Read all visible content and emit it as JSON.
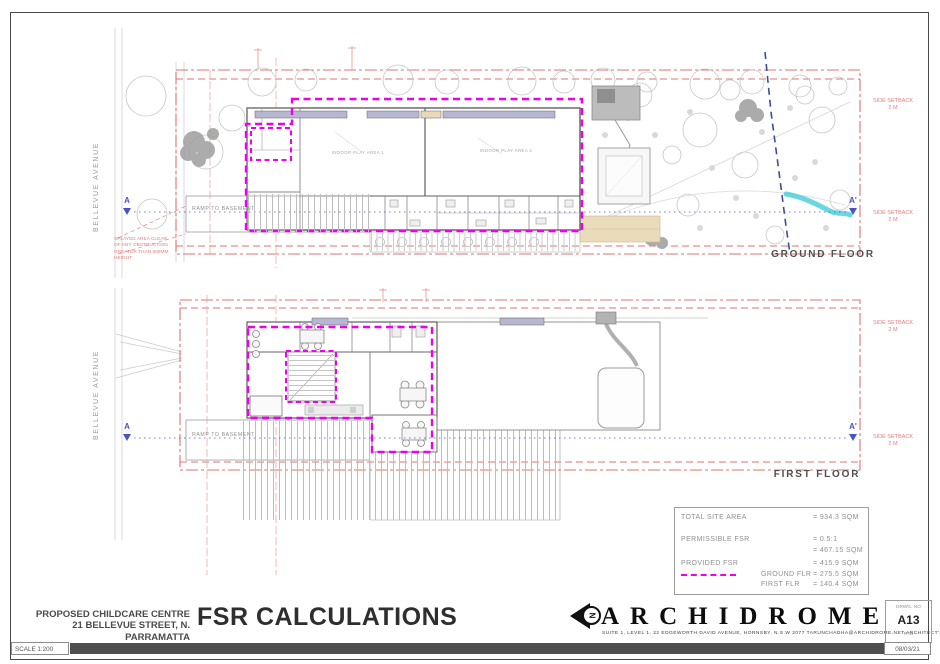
{
  "page": {
    "scale_label": "SCALE 1:200",
    "date": "08/03/21"
  },
  "title_block": {
    "project_line1": "PROPOSED CHILDCARE CENTRE",
    "project_line2": "21 BELLEVUE STREET, N. PARRAMATTA",
    "sheet_title": "FSR CALCULATIONS",
    "firm_name": "ARCHIDROME",
    "north_letter": "N",
    "firm_details": "SUITE 1, LEVEL 1, 22 EDGEWORTH DAVID AVENUE, HORNSBY, N.S.W 2077     TARUNCHADHA@ARCHIDROME.NET     ARCHITECT'S REG. NO. 8777",
    "drwg_no_label": "DRWG. NO",
    "drwg_no": "A13",
    "revision": "R-00"
  },
  "fsr_table": {
    "total_label": "TOTAL SITE AREA",
    "total_value": "= 934.3 SQM",
    "permissible_label": "PERMISSIBLE FSR",
    "permissible_ratio": "= 0.5:1",
    "permissible_value": "= 467.15 SQM",
    "provided_label": "PROVIDED FSR",
    "provided_value": "= 415.9 SQM",
    "ground_label": "GROUND FLR",
    "ground_value": "= 275.5 SQM",
    "first_label": "FIRST FLR",
    "first_value": "= 140.4 SQM"
  },
  "plans": {
    "street_name": "BELLEVUE AVENUE",
    "ramp_label": "RAMP TO BASEMENT",
    "setback_line1": "SIDE SETBACK",
    "setback_line2": "2 M",
    "section_a": "A",
    "section_a_prime": "A'",
    "ground_floor_label": "GROUND FLOOR",
    "first_floor_label": "FIRST FLOOR",
    "splay_note_line1": "SPLAYED AREA CLEAR",
    "splay_note_line2": "OF ANY OBSTRUCTION",
    "splay_note_line3": "GREATER THAN 600MM",
    "splay_note_line4": "HEIGHT",
    "room_play_area_1": "INDOOR PLAY AREA 1",
    "room_play_area_2": "INDOOR PLAY AREA 2"
  },
  "colors": {
    "magenta": "#ee00ee",
    "boundary_red": "#dd7472",
    "section_blue": "#4953c8",
    "sewer_navy": "#3f4b96",
    "creek_cyan": "#4fd0dd",
    "path_tan": "#eadcba"
  }
}
